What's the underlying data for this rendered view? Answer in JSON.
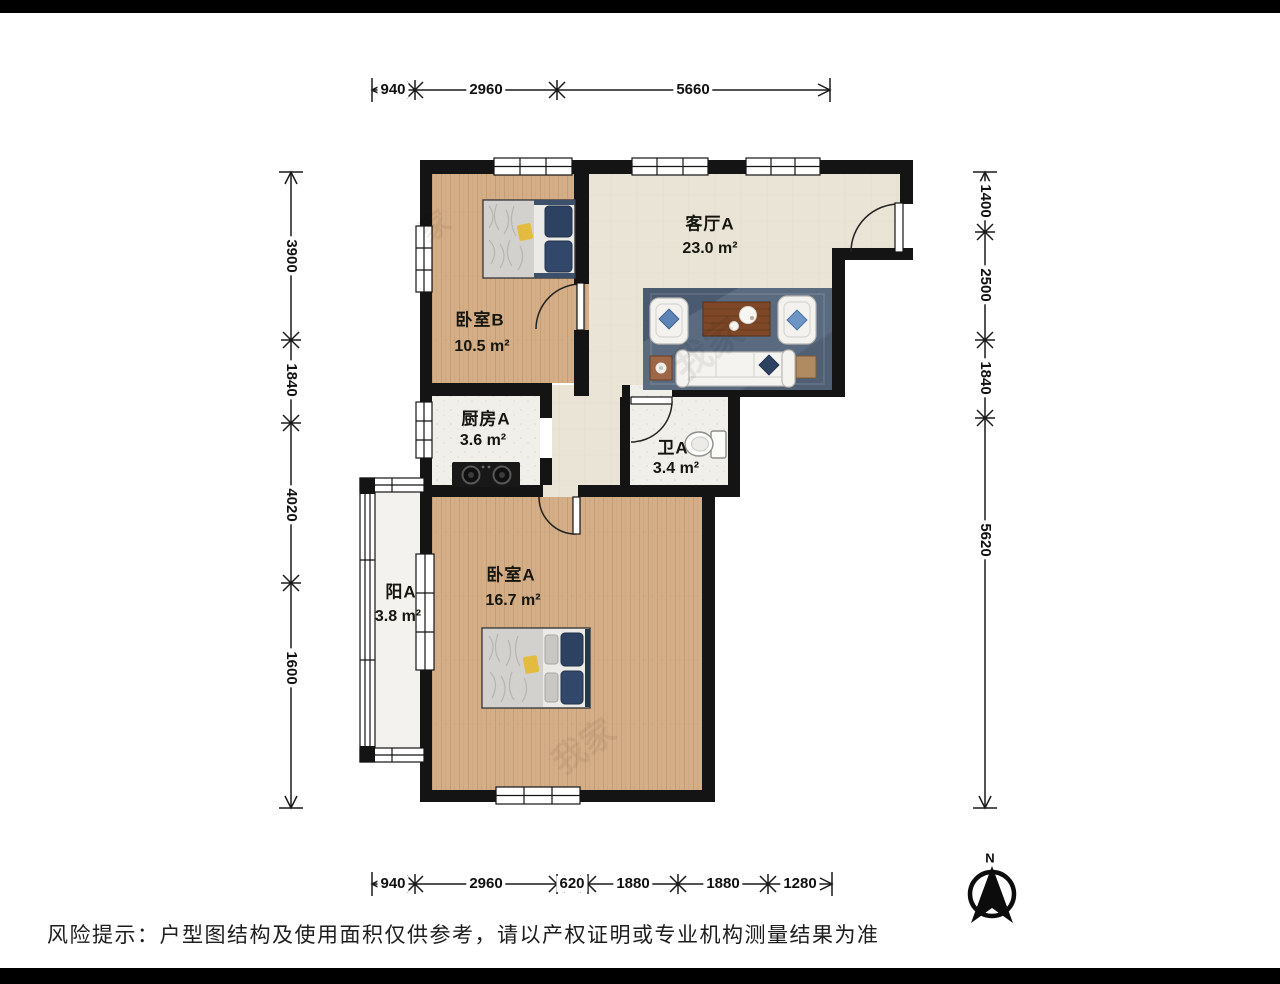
{
  "doc": {
    "type": "apartment-floor-plan",
    "disclaimer": "风险提示：户型图结构及使用面积仅供参考，请以产权证明或专业机构测量结果为准"
  },
  "rooms": {
    "living": {
      "name": "客厅A",
      "area": "23.0 m²"
    },
    "bedroom_b": {
      "name": "卧室B",
      "area": "10.5 m²"
    },
    "kitchen": {
      "name": "厨房A",
      "area": "3.6 m²"
    },
    "bath": {
      "name": "卫A",
      "area": "3.4 m²"
    },
    "balcony": {
      "name": "阳A",
      "area": "3.8 m²"
    },
    "bedroom_a": {
      "name": "卧室A",
      "area": "16.7 m²"
    }
  },
  "dimensions": {
    "top": [
      "940",
      "2960",
      "5660"
    ],
    "bottom": [
      "940",
      "2960",
      "620",
      "1880",
      "1880",
      "1280"
    ],
    "left": [
      "3900",
      "1840",
      "4020",
      "1600"
    ],
    "right": [
      "1400",
      "2500",
      "1840",
      "5620"
    ]
  },
  "compass": {
    "label": "N"
  },
  "watermarks": [
    "家",
    "我家",
    "我家"
  ],
  "colors": {
    "wall": "#141414",
    "wood_floor": "#d4ae86",
    "tile_floor": "#e9e4d6",
    "service_floor": "#f0efea",
    "balcony_floor": "#f3f2ee",
    "rug": "#5a6a7f",
    "pillow_navy": "#2d4263",
    "pillow_blue": "#6f95c6",
    "accent_yellow": "#e3bc3f",
    "table_wood": "#7d4728"
  }
}
